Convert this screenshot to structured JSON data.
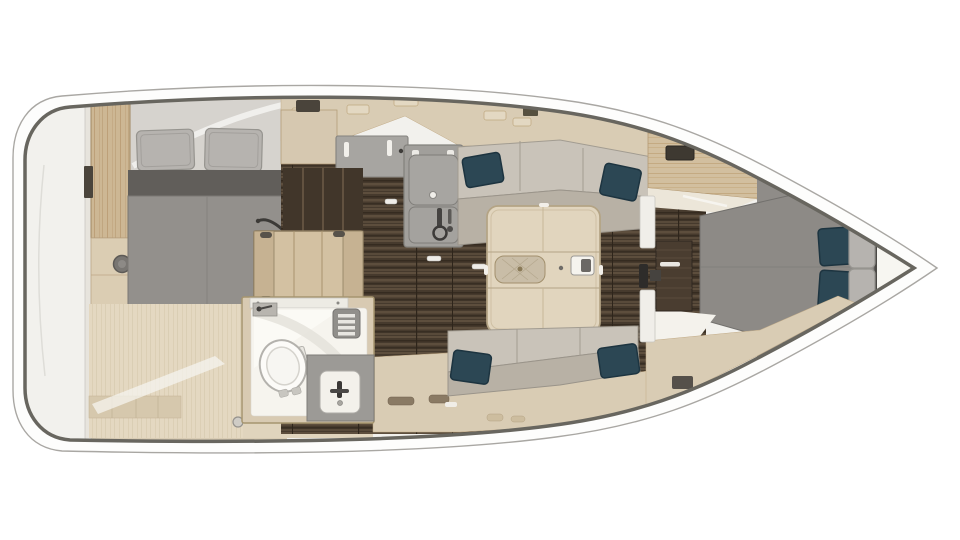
{
  "meta": {
    "description": "Top-down interior floor plan render of a sailing yacht, bow pointing right, stern at left",
    "view": "overhead",
    "orientation": "bow-right"
  },
  "palette": {
    "background": "#ffffff",
    "hull_fill": "#fdfdfc",
    "hull_edge": "#a9a7a3",
    "hull_outline": "#68665f",
    "deck": "#f2f1ed",
    "cabinetry": "#d9ccb4",
    "cabinetry_light": "#e3d8c2",
    "wood_trim": "#b29872",
    "floor_light": "#e4d8c1",
    "floor_dark": "#463a2d",
    "floor_dark_stripe": "#5d4e3d",
    "counter": "#a7a5a1",
    "counter_panel": "#a19f9b",
    "sofa_back": "#c9c3b9",
    "sofa_seat": "#b8b1a5",
    "pillow_teal": "#2c4754",
    "pillow_teal_dark": "#1d3440",
    "pillow_gray": "#b6b3af",
    "mattress": "#93908c",
    "mattress_dark": "#615e5a",
    "bed_fwd": "#8d8a86",
    "bow_liner": "#8f8c88",
    "table_wood": "#e1d5be",
    "table_edge": "#b4a485",
    "fixture_white": "#f6f4ee",
    "steps_wood": "#d3c1a2",
    "door_wood": "#4a3d30",
    "hardware_dark": "#2e2c2a"
  },
  "rooms": [
    {
      "id": "stern-deck",
      "label": "stern deck / transom"
    },
    {
      "id": "aft-cabin",
      "label": "aft cabin with double berth"
    },
    {
      "id": "galley",
      "label": "galley with sink unit and counters"
    },
    {
      "id": "salon",
      "label": "salon with two settees and table"
    },
    {
      "id": "head",
      "label": "head with toilet, vanity sink and vent"
    },
    {
      "id": "forward-cabin",
      "label": "forward cabin with V-berth"
    }
  ],
  "furniture": [
    "aft-berth-pillows",
    "aft-berth-mattress",
    "wardrobe",
    "companionway-steps",
    "galley-counter",
    "galley-sink-unit",
    "starboard-settee",
    "port-settee",
    "teal-accent-pillows",
    "salon-table",
    "toilet",
    "vanity-sink",
    "vent-grate",
    "forward-vberth",
    "forward-cabin-door",
    "deck-lockers"
  ]
}
